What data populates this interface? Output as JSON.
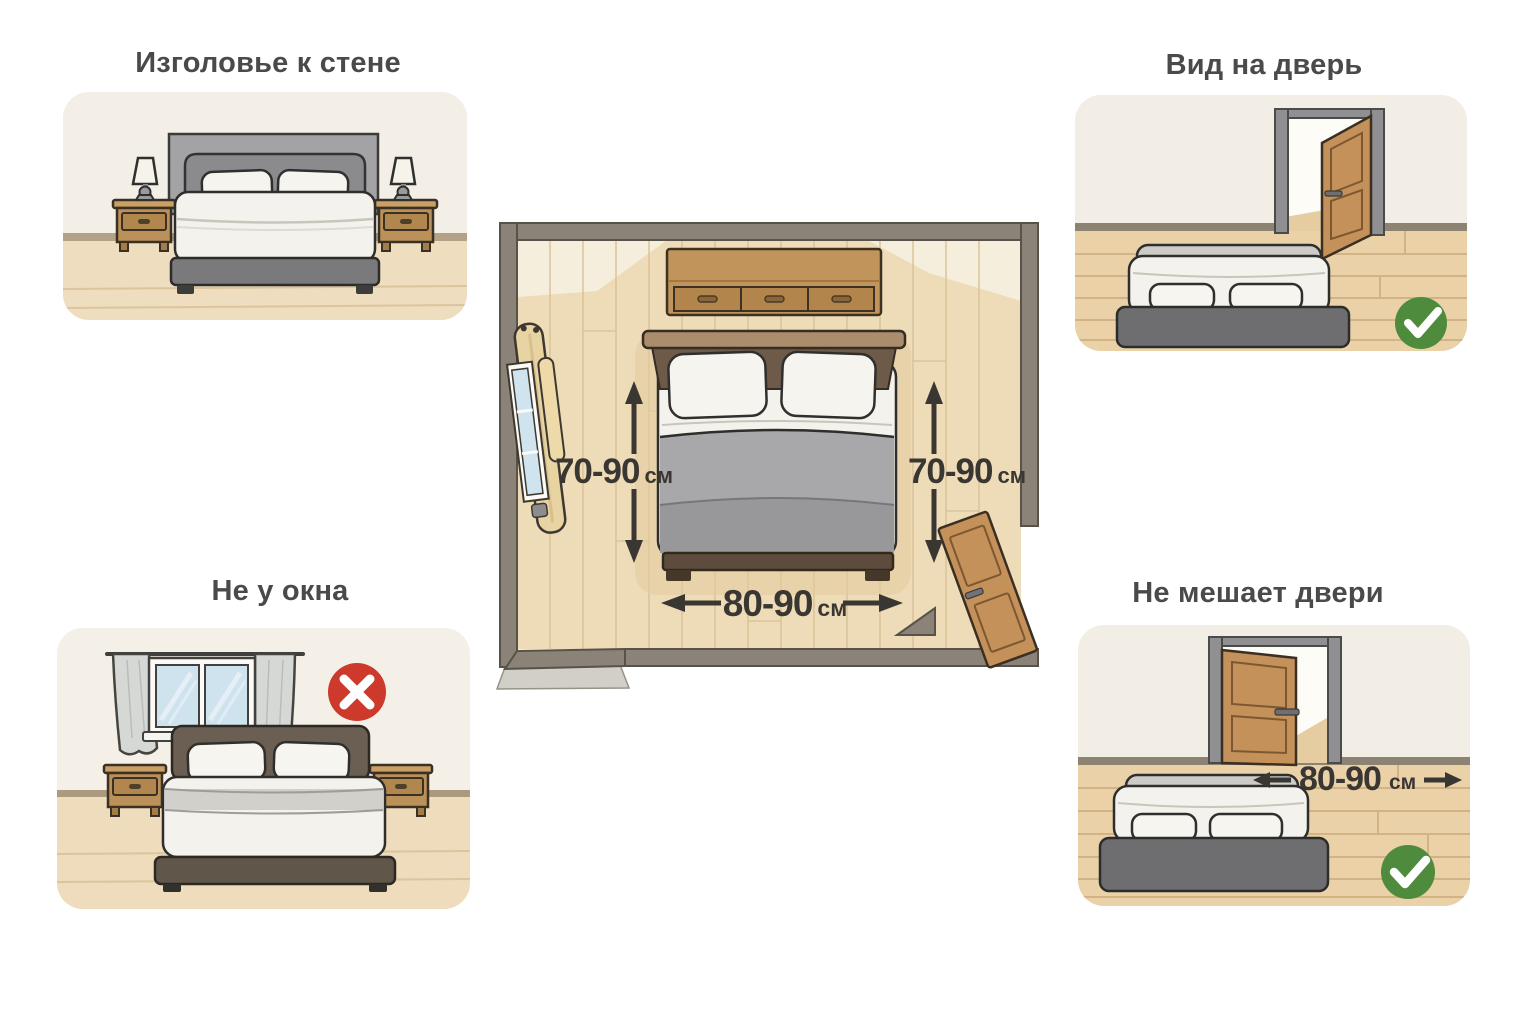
{
  "infographic": {
    "topic": "bed-placement-in-bedroom",
    "language": "ru"
  },
  "panels": {
    "headboard_to_wall": {
      "title": "Изголовье к стене"
    },
    "view_of_door": {
      "title": "Вид на дверь",
      "status": "ok",
      "status_icon": "check-icon"
    },
    "not_by_window": {
      "title": "Не у окна",
      "status": "bad",
      "status_icon": "cross-icon"
    },
    "not_blocking_door": {
      "title": "Не мешает двери",
      "status": "ok",
      "status_icon": "check-icon",
      "clearance": {
        "value": "80-90",
        "unit": "см"
      }
    }
  },
  "floor_plan": {
    "left_clearance": {
      "value": "70-90",
      "unit": "см"
    },
    "right_clearance": {
      "value": "70-90",
      "unit": "см"
    },
    "foot_clearance": {
      "value": "80-90",
      "unit": "см"
    }
  },
  "icons": {
    "approve": "check-icon",
    "reject": "cross-icon",
    "dimension": "arrow-icon"
  },
  "colors": {
    "ok_green": "#4e8b3c",
    "bad_red": "#cd392b",
    "wall_gray": "#8b8278",
    "wood": "#c0945a",
    "door_wood": "#c5915a",
    "floor_beige": "#eedcb8",
    "measure_text": "#3a3733",
    "title_text": "#4a4a49"
  }
}
